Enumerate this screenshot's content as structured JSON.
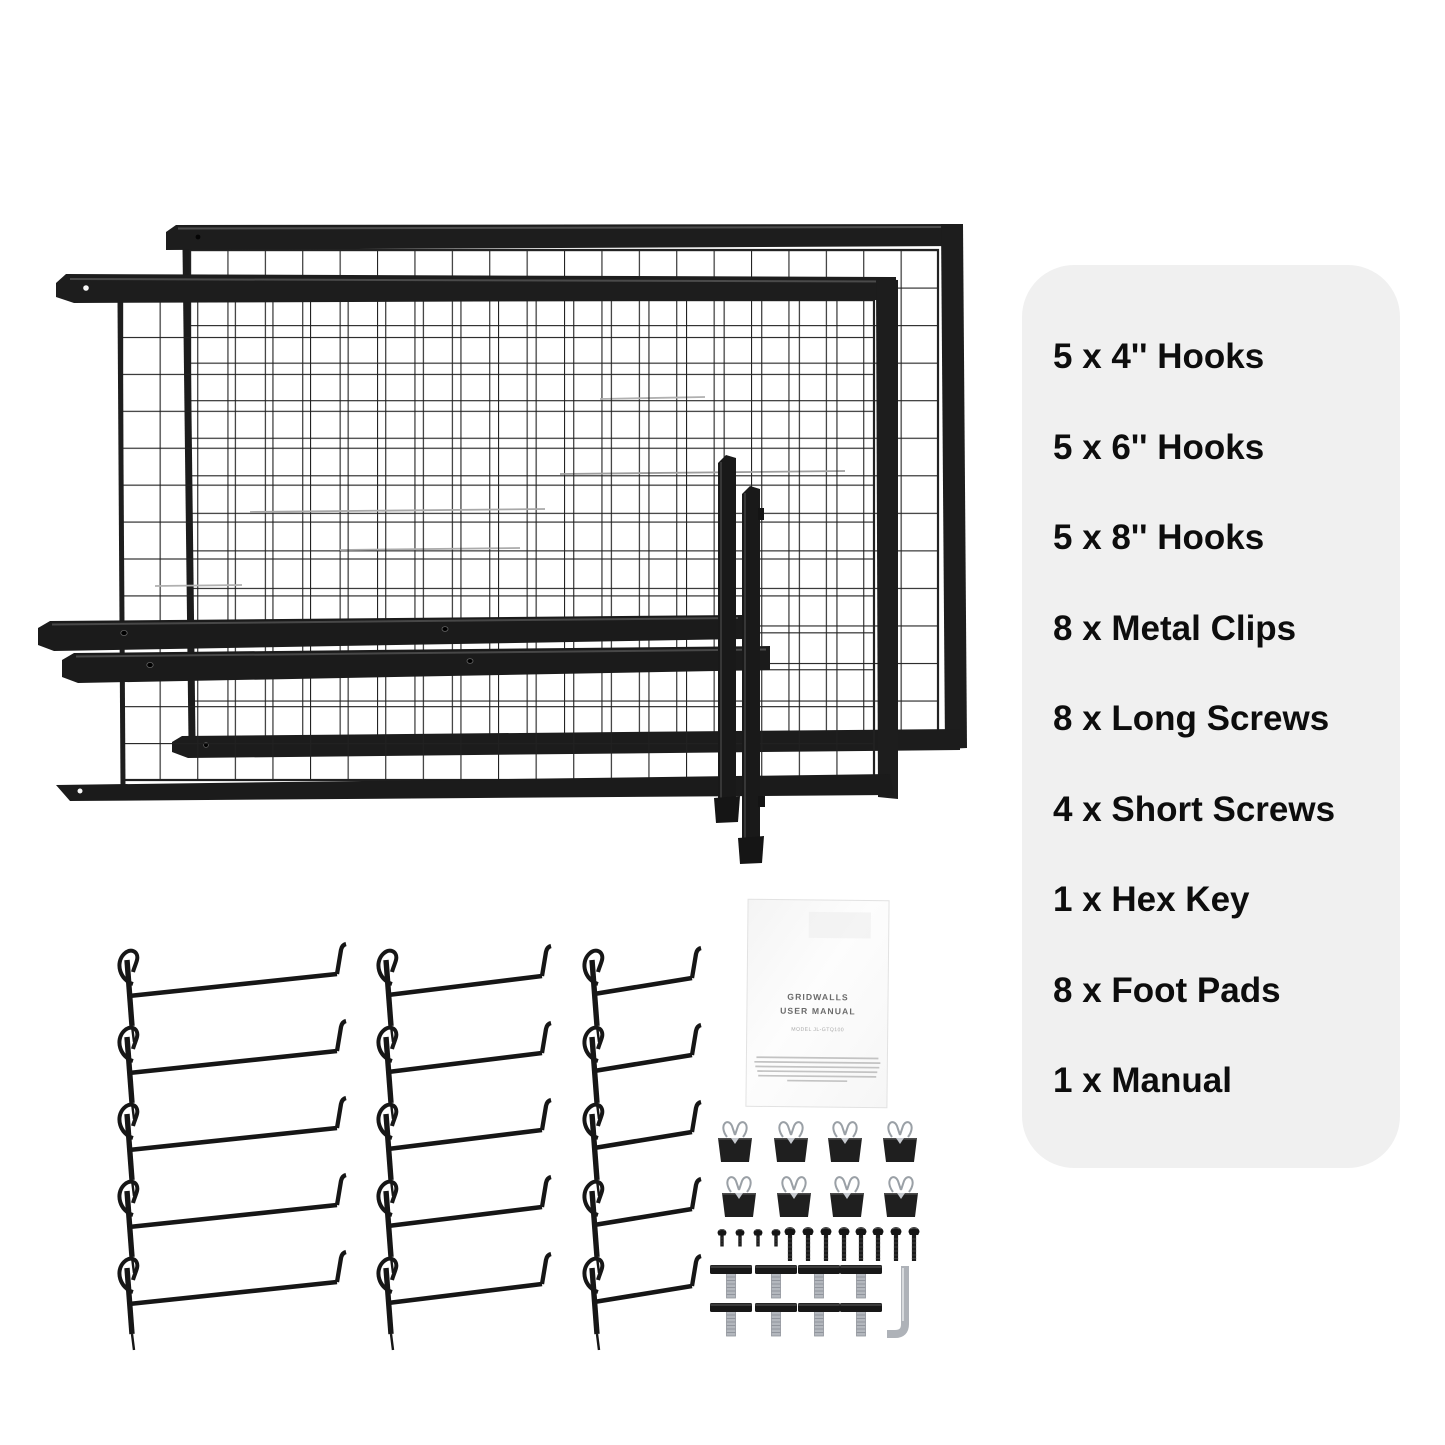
{
  "parts_panel": {
    "bg_color": "#f0f0f0",
    "items": [
      "5 x 4'' Hooks",
      "5 x 6'' Hooks",
      "5 x 8'' Hooks",
      "8 x Metal Clips",
      "8 x Long Screws",
      "4 x Short Screws",
      "1 x Hex Key",
      "8 x Foot Pads",
      "1 x Manual"
    ]
  },
  "manual": {
    "title_line1": "GRIDWALLS",
    "title_line2": "USER MANUAL",
    "model_line": "MODEL JL-GTQ100"
  },
  "colors": {
    "frame_black": "#1d1d1d",
    "wire_black": "#232323",
    "steel_silver": "#b4b8bd",
    "panel_gray": "#f0f0f0",
    "text_black": "#0d0d0d",
    "manual_white": "#fcfcfc"
  }
}
